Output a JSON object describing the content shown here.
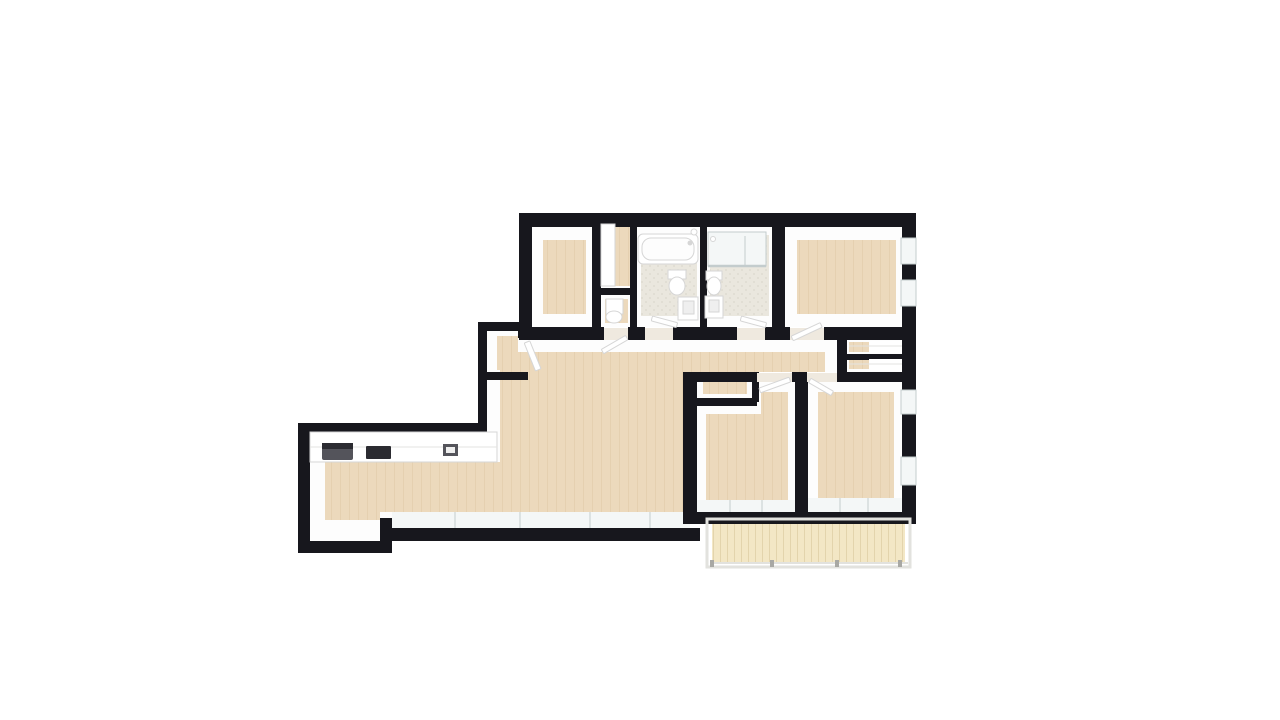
{
  "scene": {
    "kind": "3d-floorplan-render",
    "view": "top-down-perspective",
    "background": "#ffffff"
  },
  "colors": {
    "background": "#ffffff",
    "wall": "#17171d",
    "wall_face": "#fdfdfd",
    "wall_face_shade": "#f1f0ee",
    "floor_wood": "#ecd9bc",
    "floor_wood_line": "#e5d0b0",
    "floor_bath": "#eae7de",
    "floor_bath_dot": "#dfdcd1",
    "floor_balcony": "#f3e7c5",
    "balcony_plank_line": "#e3d4ac",
    "glass": "#f4f7f7",
    "glass_line": "#c3cccd",
    "fixture_white": "#ffffff",
    "fixture_outline": "#d6d6d6",
    "fixture_inner": "#efefef",
    "appliance_dark": "#2b2b31",
    "appliance_gray": "#54545b",
    "railing": "#e2e2de",
    "railing_post": "#a8a8a4",
    "threshold": "#efe9df",
    "shelf_line": "#e3e3e0"
  },
  "rooms": [
    {
      "id": "bedroom-top-left",
      "floor": "wood"
    },
    {
      "id": "storage-strip",
      "floor": "wood"
    },
    {
      "id": "wc-closet",
      "floor": "wood"
    },
    {
      "id": "bathroom-1",
      "floor": "tile",
      "fixtures": [
        "bathtub",
        "toilet",
        "sink",
        "shower-head",
        "door-leaf"
      ]
    },
    {
      "id": "bathroom-2",
      "floor": "tile",
      "fixtures": [
        "shower",
        "toilet",
        "sink",
        "door-leaf"
      ]
    },
    {
      "id": "bedroom-top-right",
      "floor": "wood",
      "windows": 2,
      "fixtures": [
        "door-leaf"
      ]
    },
    {
      "id": "hallway",
      "floor": "wood"
    },
    {
      "id": "closet-upper",
      "floor": "wood",
      "fixtures": [
        "shelf"
      ]
    },
    {
      "id": "closet-lower",
      "floor": "wood",
      "fixtures": [
        "shelf"
      ]
    },
    {
      "id": "living-room-kitchen",
      "floor": "wood",
      "windows": 4,
      "fixtures": [
        "kitchen-counter",
        "range-hood",
        "cooktop",
        "kitchen-sink",
        "nook-door-leaf"
      ]
    },
    {
      "id": "nook-closet",
      "floor": "wood"
    },
    {
      "id": "bedroom-bottom-left",
      "floor": "wood",
      "windows": 2,
      "fixtures": [
        "door-leaf",
        "niche"
      ]
    },
    {
      "id": "bedroom-bottom-right",
      "floor": "wood",
      "windows": 4,
      "fixtures": [
        "door-leaf"
      ]
    },
    {
      "id": "balcony",
      "floor": "plank",
      "fixtures": [
        "railing"
      ]
    }
  ]
}
